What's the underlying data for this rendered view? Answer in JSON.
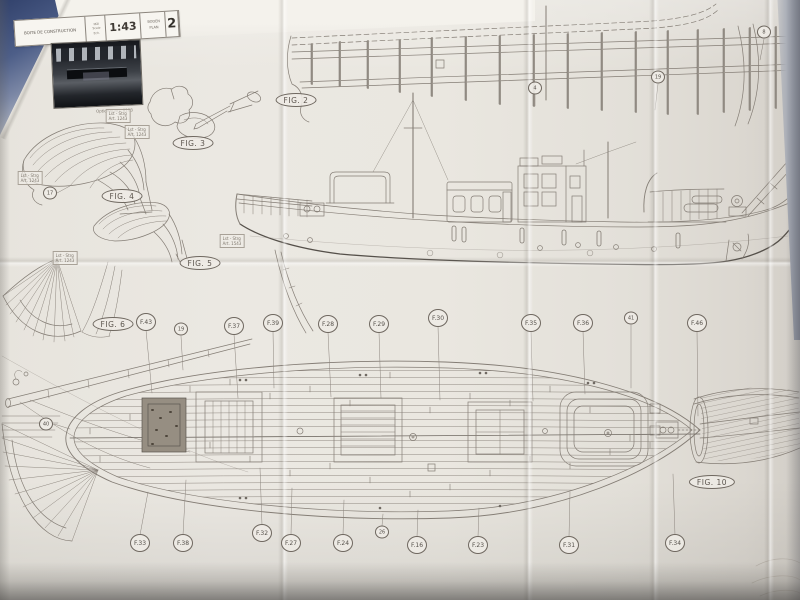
{
  "title_block": {
    "kit_label": "BOITE DE CONSTRUCTION",
    "scale_sub": [
      "Mål",
      "Scale",
      "Ech."
    ],
    "scale": "1:43",
    "plan_lines": [
      "BODEN",
      "PLAN"
    ],
    "sheet": "2"
  },
  "photo": {
    "caption": "Optional Art. 8103"
  },
  "figures": [
    {
      "label": "FIG. 2",
      "x": 296,
      "y": 100
    },
    {
      "label": "FIG. 3",
      "x": 193,
      "y": 143
    },
    {
      "label": "FIG. 4",
      "x": 122,
      "y": 196
    },
    {
      "label": "FIG. 5",
      "x": 200,
      "y": 263
    },
    {
      "label": "FIG. 6",
      "x": 113,
      "y": 324
    },
    {
      "label": "FIG. 10",
      "x": 712,
      "y": 482
    }
  ],
  "top_callouts": [
    {
      "label": "F.43",
      "x": 146,
      "y": 322
    },
    {
      "label": "19",
      "x": 181,
      "y": 329,
      "small": true
    },
    {
      "label": "F.37",
      "x": 234,
      "y": 326
    },
    {
      "label": "F.39",
      "x": 273,
      "y": 323
    },
    {
      "label": "F.28",
      "x": 328,
      "y": 324
    },
    {
      "label": "F.29",
      "x": 379,
      "y": 324
    },
    {
      "label": "F.30",
      "x": 438,
      "y": 318
    },
    {
      "label": "F.35",
      "x": 531,
      "y": 323
    },
    {
      "label": "F.36",
      "x": 583,
      "y": 323
    },
    {
      "label": "41",
      "x": 631,
      "y": 318,
      "small": true
    },
    {
      "label": "F.46",
      "x": 697,
      "y": 323
    }
  ],
  "bottom_callouts": [
    {
      "label": "F.33",
      "x": 140,
      "y": 543
    },
    {
      "label": "F.38",
      "x": 183,
      "y": 543
    },
    {
      "label": "F.32",
      "x": 262,
      "y": 533
    },
    {
      "label": "F.27",
      "x": 291,
      "y": 543
    },
    {
      "label": "F.24",
      "x": 343,
      "y": 543
    },
    {
      "label": "26",
      "x": 382,
      "y": 532,
      "small": true
    },
    {
      "label": "F.16",
      "x": 417,
      "y": 545
    },
    {
      "label": "F.23",
      "x": 478,
      "y": 545
    },
    {
      "label": "F.31",
      "x": 569,
      "y": 545
    },
    {
      "label": "F.34",
      "x": 675,
      "y": 543
    }
  ],
  "number_callouts": [
    {
      "label": "17",
      "x": 50,
      "y": 193,
      "small": true
    },
    {
      "label": "4",
      "x": 535,
      "y": 88,
      "small": true
    },
    {
      "label": "19",
      "x": 658,
      "y": 77,
      "small": true
    },
    {
      "label": "8",
      "x": 764,
      "y": 32,
      "small": true
    },
    {
      "label": "40",
      "x": 46,
      "y": 424,
      "small": true
    }
  ],
  "notes": [
    {
      "line1": "Lst - Strg",
      "line2": "Art. 1243",
      "x": 118,
      "y": 116
    },
    {
      "line1": "Lst - Strg",
      "line2": "Art. 1243",
      "x": 137,
      "y": 132
    },
    {
      "line1": "Lst - Strg",
      "line2": "Art. 1243",
      "x": 30,
      "y": 178
    },
    {
      "line1": "Lst - Strg",
      "line2": "Art. 1543",
      "x": 232,
      "y": 241
    },
    {
      "line1": "Lst - Strg",
      "line2": "Art. 1243",
      "x": 65,
      "y": 258
    }
  ]
}
